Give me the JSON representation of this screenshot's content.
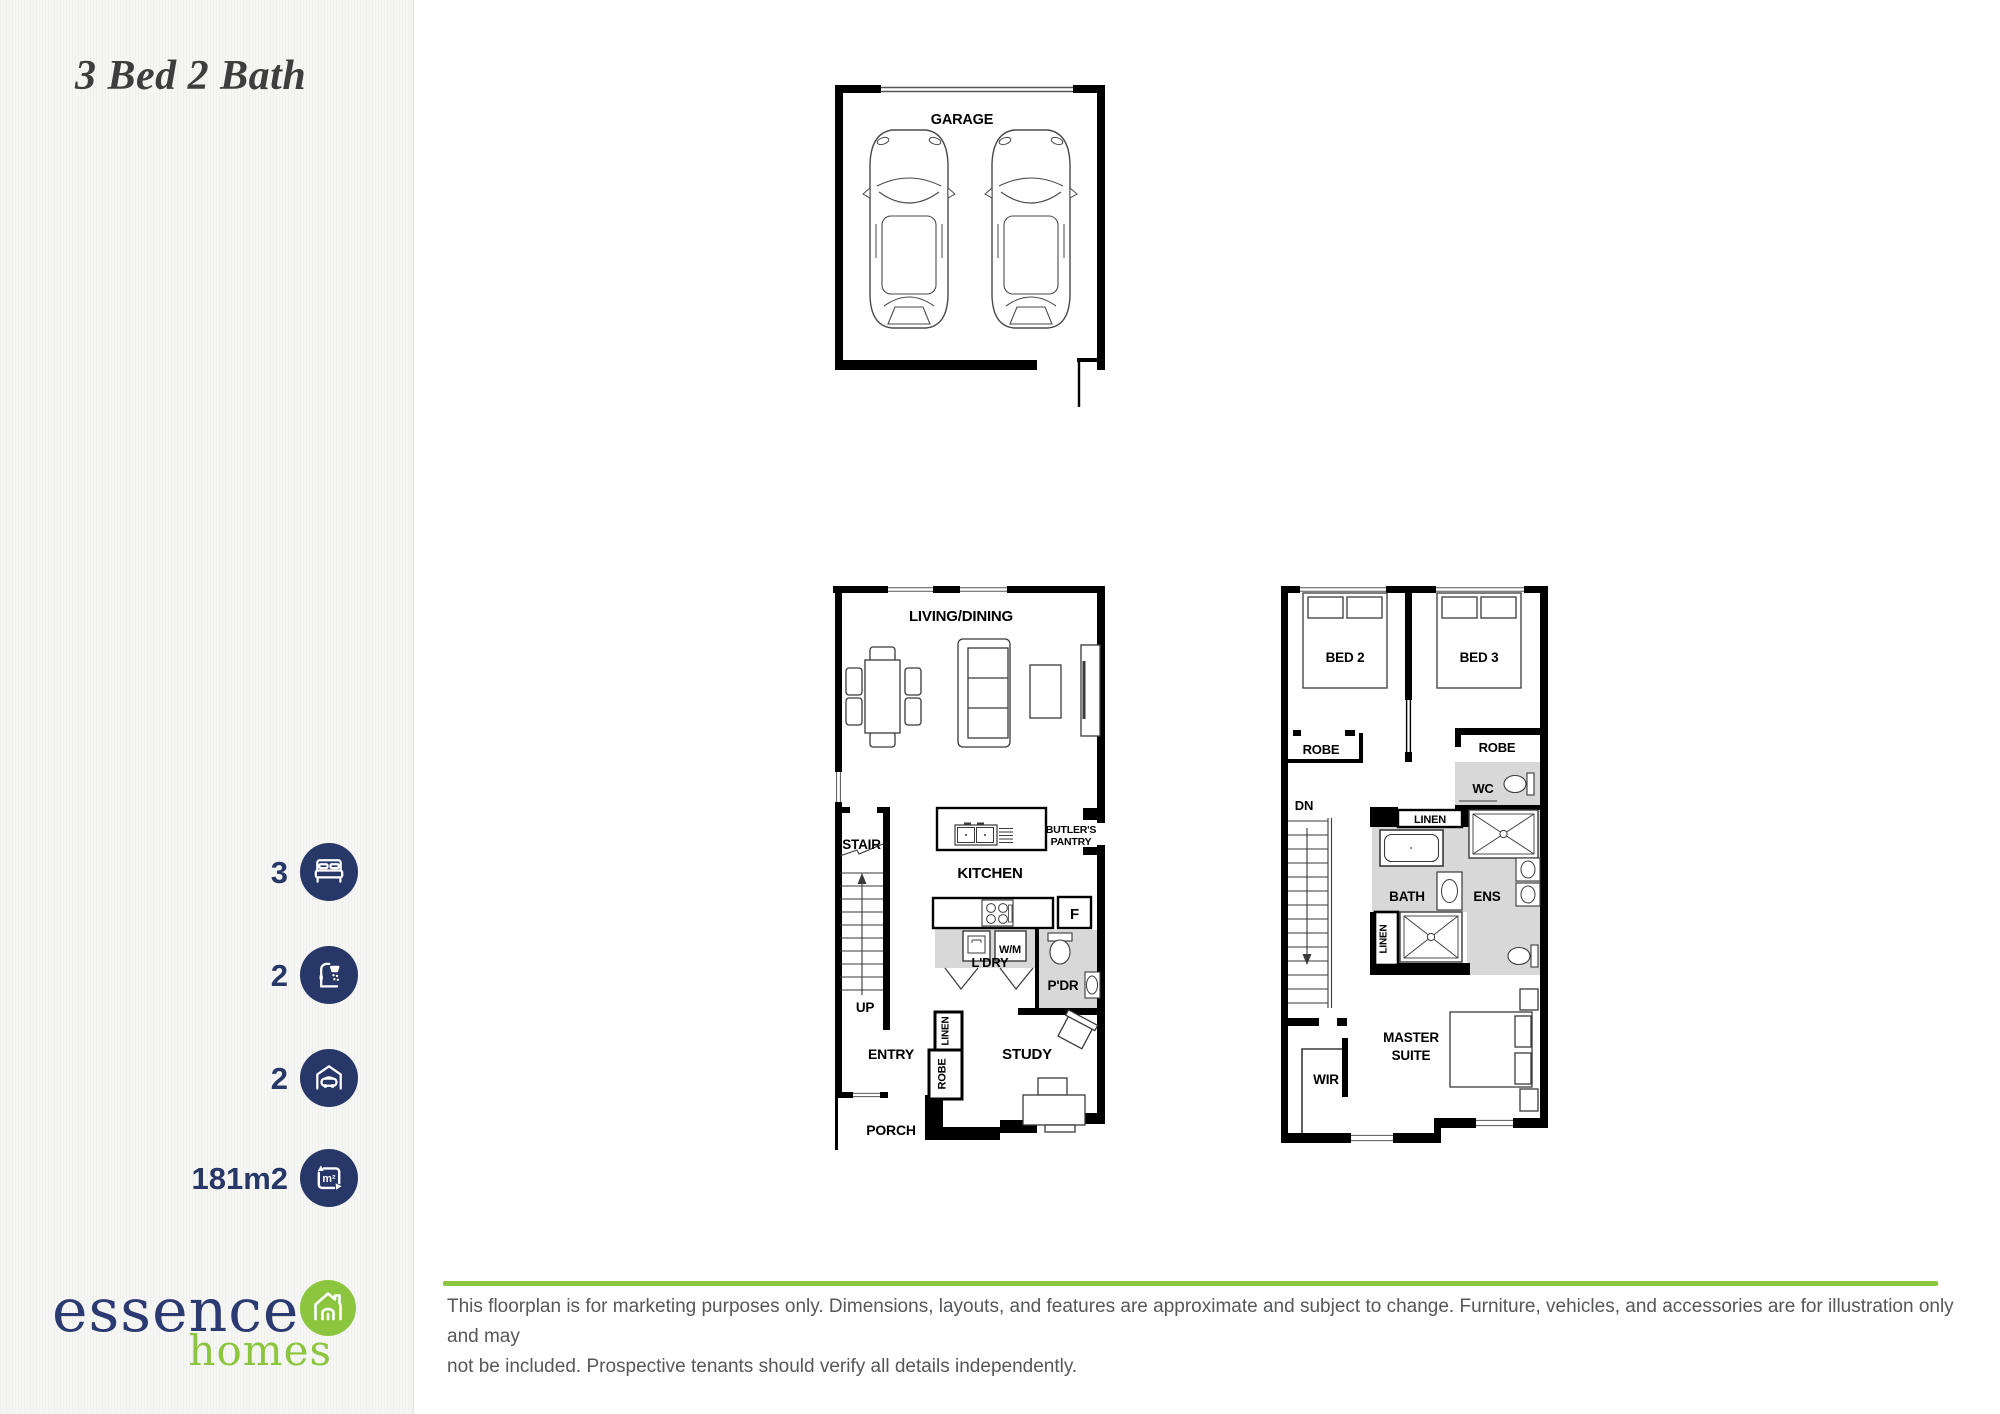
{
  "colors": {
    "navy": "#273767",
    "green": "#8cc63e",
    "room_gray": "#d8d8d8",
    "title_gray": "#3e3e3e",
    "disclaimer_gray": "#565759"
  },
  "sidebar": {
    "title": "3 Bed 2 Bath",
    "specs": [
      {
        "value": "3",
        "icon": "bed"
      },
      {
        "value": "2",
        "icon": "shower"
      },
      {
        "value": "2",
        "icon": "car-garage"
      },
      {
        "value": "181m2",
        "icon": "floor-area",
        "icon_label": "m²"
      }
    ],
    "logo": {
      "name": "essence",
      "suffix": "homes"
    }
  },
  "floorplan": {
    "garage": {
      "label": "GARAGE"
    },
    "ground": {
      "living_dining": "LIVING/DINING",
      "stair": "STAIR",
      "up": "UP",
      "kitchen": "KITCHEN",
      "butlers_pantry_line1": "BUTLER'S",
      "butlers_pantry_line2": "PANTRY",
      "fridge": "F",
      "wm": "W/M",
      "ldry": "L'DRY",
      "pdr": "P'DR",
      "linen": "LINEN",
      "robe": "ROBE",
      "entry": "ENTRY",
      "study": "STUDY",
      "porch": "PORCH"
    },
    "upper": {
      "bed2": "BED 2",
      "bed3": "BED 3",
      "robe_left": "ROBE",
      "robe_right": "ROBE",
      "wc": "WC",
      "dn": "DN",
      "linen_top": "LINEN",
      "bath": "BATH",
      "ens": "ENS",
      "linen_side": "LINEN",
      "master_line1": "MASTER",
      "master_line2": "SUITE",
      "wir": "WIR"
    }
  },
  "footer": {
    "disclaimer_line1": "This floorplan is for marketing purposes only. Dimensions, layouts, and features are approximate and subject to change. Furniture, vehicles, and accessories are for illustration only and may",
    "disclaimer_line2": "not be included. Prospective tenants should verify all details independently."
  }
}
